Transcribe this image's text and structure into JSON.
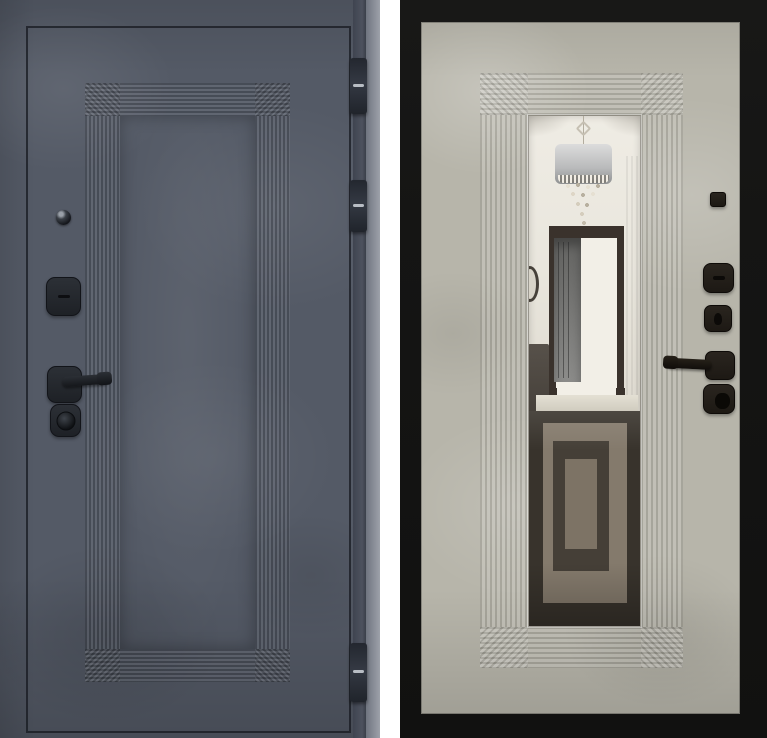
{
  "scene": {
    "title": "Steel entry door shown from both sides",
    "left_panel": {
      "name": "door-exterior-graphite",
      "finish": "dark graphite concrete texture",
      "features": [
        "stepped-rectangular-panel-molding",
        "thin-leaf-outline"
      ],
      "hardware": [
        "peephole",
        "lock-escutcheon",
        "lever-handle",
        "cylinder-lock"
      ],
      "hinge_count": 3
    },
    "right_panel": {
      "name": "door-interior-beige-mirror",
      "finish": "light beige concrete texture with black steel frame",
      "features": [
        "stepped-molding-around-mirror",
        "full-length-mirror"
      ],
      "mirror_reflection": [
        "white-ceiling",
        "crystal-drum-chandelier",
        "dark-framed-doorway",
        "gray-interior-door",
        "round-wall-mirror-edge",
        "dark-cabinet",
        "dark-geometric-rug-floor"
      ],
      "hardware": [
        "night-latch-square",
        "lock-escutcheon",
        "keyhole-escutcheon",
        "lever-handle",
        "thumb-turn-knob"
      ]
    }
  },
  "colors": {
    "left-face": "#545a66",
    "left-edge": "#3f4450",
    "outline": "#171a20",
    "hinge-pin": "#c7ccd3",
    "frame-black": "#151514",
    "right-face": "#b7b5aa",
    "mirror-top": "#efece4",
    "mirror-bottom": "#d5d1c5",
    "portal": "#3a322c",
    "floor-dark": "#38332c",
    "rug-light": "#847a6c",
    "rug-mid": "#453f37",
    "rug-light2": "#7d7365",
    "threshold": "#e4e0d4",
    "cabinet": "#3a352f",
    "shade-light": "#dcdcdc",
    "shade-dark": "#8f9192",
    "hw-brown": "#1d1914"
  }
}
